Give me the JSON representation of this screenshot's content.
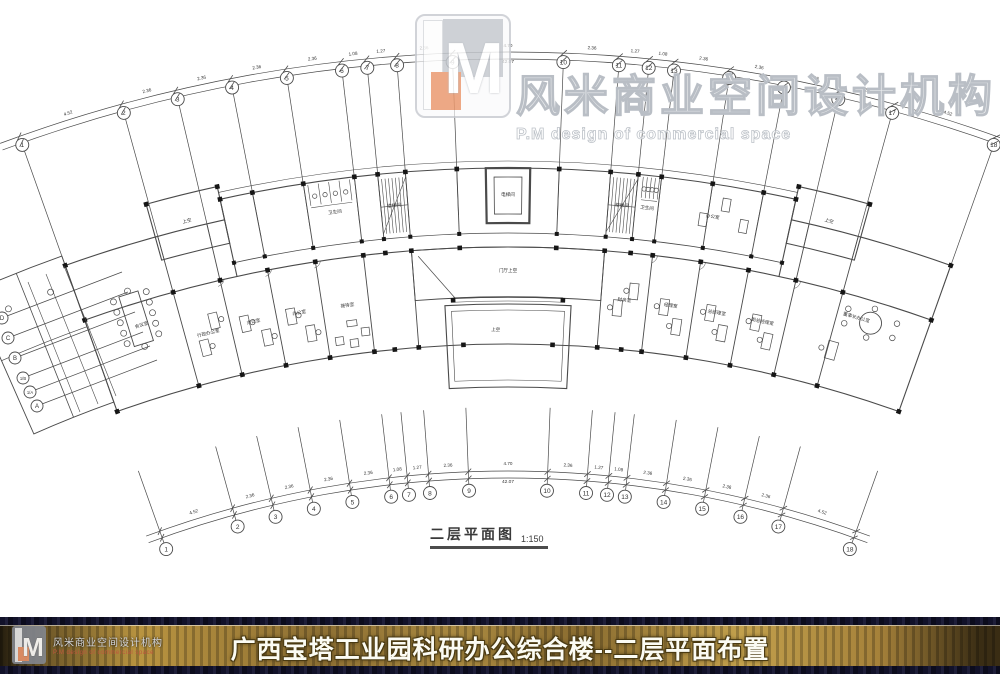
{
  "watermark": {
    "logo_letter": "M",
    "cn": "风米商业空间设计机构",
    "en": "P.M design of commercial space"
  },
  "plan": {
    "caption_title": "二层平面图",
    "caption_scale": "1:150",
    "grid": {
      "labels": [
        "1",
        "2",
        "3",
        "4",
        "5",
        "6",
        "7",
        "8",
        "9",
        "10",
        "11",
        "12",
        "13",
        "14",
        "15",
        "16",
        "17",
        "18"
      ],
      "spans": [
        4.52,
        2.36,
        2.36,
        2.36,
        2.36,
        1.08,
        1.27,
        2.36,
        4.7,
        2.36,
        1.27,
        1.08,
        2.36,
        2.36,
        2.36,
        2.36,
        4.52
      ],
      "span_labels": [
        "4.52",
        "2.36",
        "2.36",
        "2.36",
        "2.36",
        "1.08",
        "1.27",
        "2.36",
        "4.70",
        "2.36",
        "1.27",
        "1.08",
        "2.36",
        "2.36",
        "2.36",
        "2.36",
        "4.52"
      ],
      "total_label": "42.07"
    },
    "left_grid": {
      "labels": [
        "D",
        "C",
        "B",
        "1/B",
        "1/A",
        "A"
      ]
    },
    "rooms": [
      {
        "label": "会议室",
        "t": -17.2,
        "r": 1238
      },
      {
        "label": "行政办公室",
        "t": -14.3,
        "r": 1212
      },
      {
        "label": "办公室",
        "t": -12.1,
        "r": 1213
      },
      {
        "label": "办公室",
        "t": -9.9,
        "r": 1213
      },
      {
        "label": "接待室",
        "t": -7.6,
        "r": 1213
      },
      {
        "label": "门厅上空",
        "t": 0,
        "r": 1237
      },
      {
        "label": "上空",
        "t": -0.6,
        "r": 1178
      },
      {
        "label": "财务室",
        "t": 5.5,
        "r": 1213
      },
      {
        "label": "经理室",
        "t": 7.7,
        "r": 1213
      },
      {
        "label": "总经理室",
        "t": 9.9,
        "r": 1213
      },
      {
        "label": "副总经理室",
        "t": 12.1,
        "r": 1213
      },
      {
        "label": "董事长办公室",
        "t": 16.3,
        "r": 1240
      },
      {
        "label": "卫生间",
        "t": -7.6,
        "r": 1307
      },
      {
        "label": "楼梯间",
        "t": -5.0,
        "r": 1307
      },
      {
        "label": "电梯间",
        "t": 0,
        "r": 1313
      },
      {
        "label": "楼梯间",
        "t": 5.0,
        "r": 1307
      },
      {
        "label": "卫生间",
        "t": 6.1,
        "r": 1307
      },
      {
        "label": "办公室",
        "t": 9.0,
        "r": 1307
      },
      {
        "label": "上空",
        "t": -14.0,
        "r": 1326
      },
      {
        "label": "上空",
        "t": 14.0,
        "r": 1326
      }
    ]
  },
  "footer": {
    "title": "广西宝塔工业园科研办公综合楼--二层平面布置",
    "cn": "风米商业空间设计机构",
    "en": "P.M design of commercial space"
  }
}
